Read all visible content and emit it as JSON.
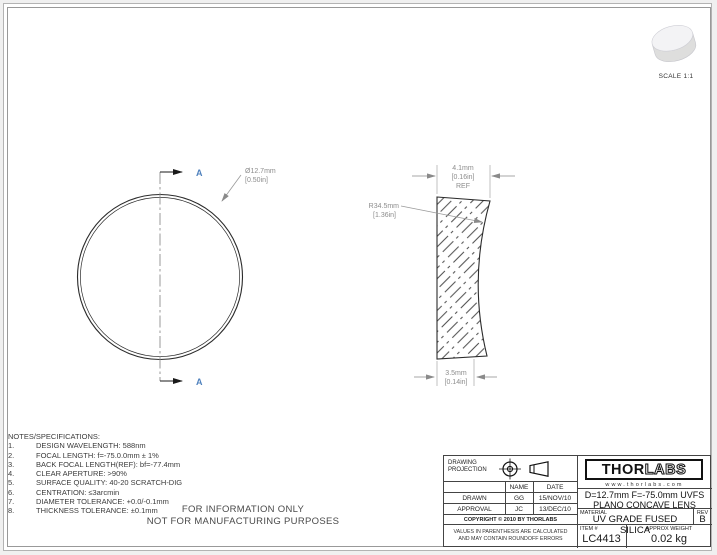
{
  "colors": {
    "accent_blue": "#4f81bd",
    "dim_text": "#8c8c8c",
    "line": "#2b2b2b"
  },
  "scale": {
    "label": "SCALE 1:1"
  },
  "front_view": {
    "section_top": "A",
    "section_bottom": "A",
    "diameter": "Ø12.7mm",
    "diameter_in": "[0.50in]"
  },
  "section_view": {
    "edge_thickness": "4.1mm",
    "edge_thickness_in": "[0.16in]",
    "edge_thickness_ref": "REF",
    "radius": "R34.5mm",
    "radius_in": "[1.36in]",
    "center_thickness": "3.5mm",
    "center_thickness_in": "[0.14in]"
  },
  "notes": {
    "title": "NOTES/SPECIFICATIONS:",
    "items": [
      {
        "num": "1.",
        "text": "DESIGN WAVELENGTH: 588nm"
      },
      {
        "num": "2.",
        "text": "FOCAL LENGTH: f=-75.0.0mm ± 1%"
      },
      {
        "num": "3.",
        "text": "BACK FOCAL LENGTH(REF): bf=-77.4mm"
      },
      {
        "num": "4.",
        "text": "CLEAR APERTURE: >90%"
      },
      {
        "num": "5.",
        "text": "SURFACE QUALITY: 40-20 SCRATCH-DIG"
      },
      {
        "num": "6.",
        "text": "CENTRATION: ≤3arcmin"
      },
      {
        "num": "7.",
        "text": "DIAMETER TOLERANCE: +0.0/-0.1mm"
      },
      {
        "num": "8.",
        "text": "THICKNESS TOLERANCE: ±0.1mm"
      }
    ]
  },
  "disclaimer": {
    "line1": "FOR INFORMATION ONLY",
    "line2": "NOT FOR MANUFACTURING PURPOSES"
  },
  "title_block": {
    "projection_line1": "DRAWING",
    "projection_line2": "PROJECTION",
    "table": {
      "header": [
        "",
        "NAME",
        "DATE"
      ],
      "rows": [
        [
          "DRAWN",
          "GG",
          "15/NOV/10"
        ],
        [
          "APPROVAL",
          "JC",
          "13/DEC/10"
        ]
      ]
    },
    "copyright": "COPYRIGHT © 2010 BY THORLABS",
    "values_note_line1": "VALUES IN PARENTHESIS ARE CALCULATED",
    "values_note_line2": "AND MAY CONTAIN ROUNDOFF ERRORS",
    "logo": {
      "thor": "THOR",
      "labs": "LABS",
      "website": "www.thorlabs.com"
    },
    "title_line1": "D=12.7mm F=-75.0mm UVFS",
    "title_line2": "PLANO CONCAVE LENS",
    "material_label": "MATERIAL",
    "material": "UV GRADE FUSED SILICA",
    "rev_label": "REV",
    "rev": "B",
    "item_label": "ITEM #",
    "item": "LC4413",
    "weight_label": "APPROX WEIGHT",
    "weight": "0.02 kg"
  }
}
